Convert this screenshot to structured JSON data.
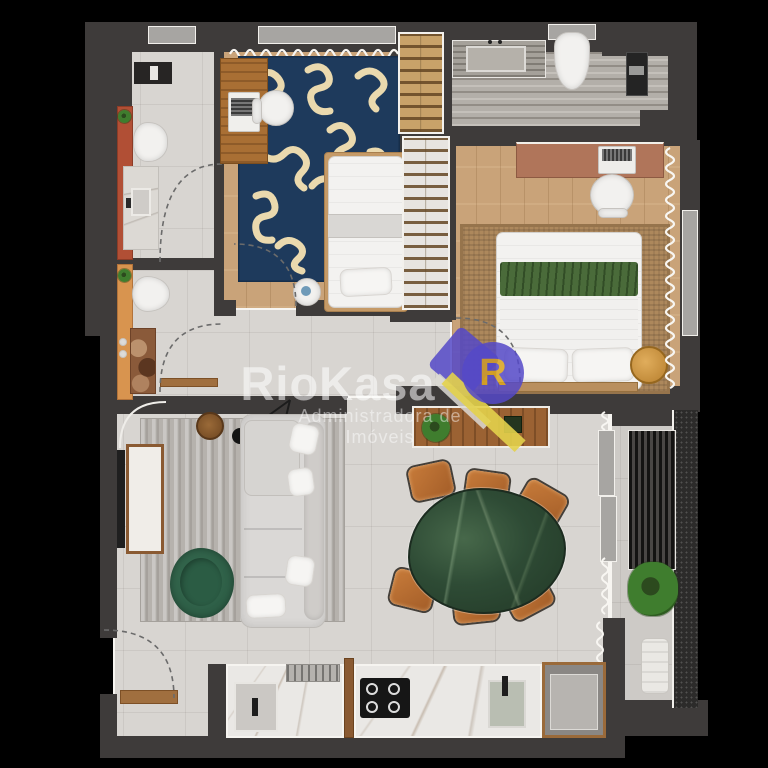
{
  "watermark": {
    "brand": "RioKasa",
    "tagline": "Administradora de Imóveis",
    "logo_letter": "R"
  },
  "palette": {
    "wall": "#3e3b3a",
    "tile": "#d8d5d1",
    "wood": "#c9a379",
    "travertine": "#b3afa9",
    "white-marble": "#eae8e5",
    "navy-rug": "#1e3a5c",
    "rug-cream": "#ead9ae",
    "jute": "#ad885c",
    "gray-rug": "#b6b2ad",
    "sofa": "#dad8d6",
    "green-chair": "#2a5a43",
    "green-marble": "#2e4b35",
    "chair-orange": "#a35d28",
    "terracotta": "#b14f35",
    "orange-vanity": "#d8944f",
    "desk-wood": "#a96f34",
    "desk-terracotta": "#b0755a",
    "bed-green-throw": "#4a6b3a",
    "plant": "#3f7d2e",
    "logo-violet": "#5549c8",
    "logo-yellow": "#e3d24b",
    "logo-amber": "#daa31c",
    "watermark": "rgba(255,255,255,0.55)"
  }
}
